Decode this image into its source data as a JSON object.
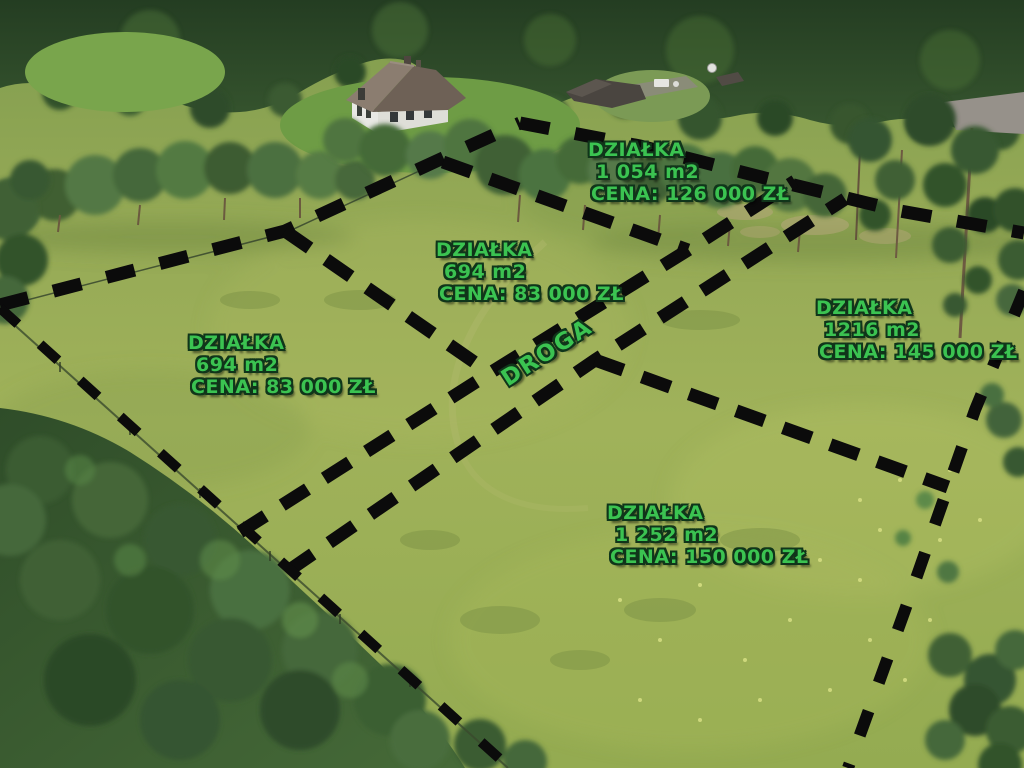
{
  "plots": [
    {
      "location": "north",
      "label": "DZIAŁKA",
      "area": "1 054 m2",
      "price": "CENA: 126 000 ZŁ"
    },
    {
      "location": "center",
      "label": "DZIAŁKA",
      "area": "694 m2",
      "price": "CENA: 83 000 ZŁ"
    },
    {
      "location": "west",
      "label": "DZIAŁKA",
      "area": "694 m2",
      "price": "CENA: 83 000 ZŁ"
    },
    {
      "location": "east",
      "label": "DZIAŁKA",
      "area": "1216 m2",
      "price": "CENA: 145 000 ZŁ"
    },
    {
      "location": "south",
      "label": "DZIAŁKA",
      "area": "1 252 m2",
      "price": "CENA: 150 000 ZŁ"
    }
  ],
  "road": {
    "label": "DROGA"
  },
  "colors": {
    "label_text": "#3bc351",
    "boundary_dash": "#0b0b0b"
  }
}
